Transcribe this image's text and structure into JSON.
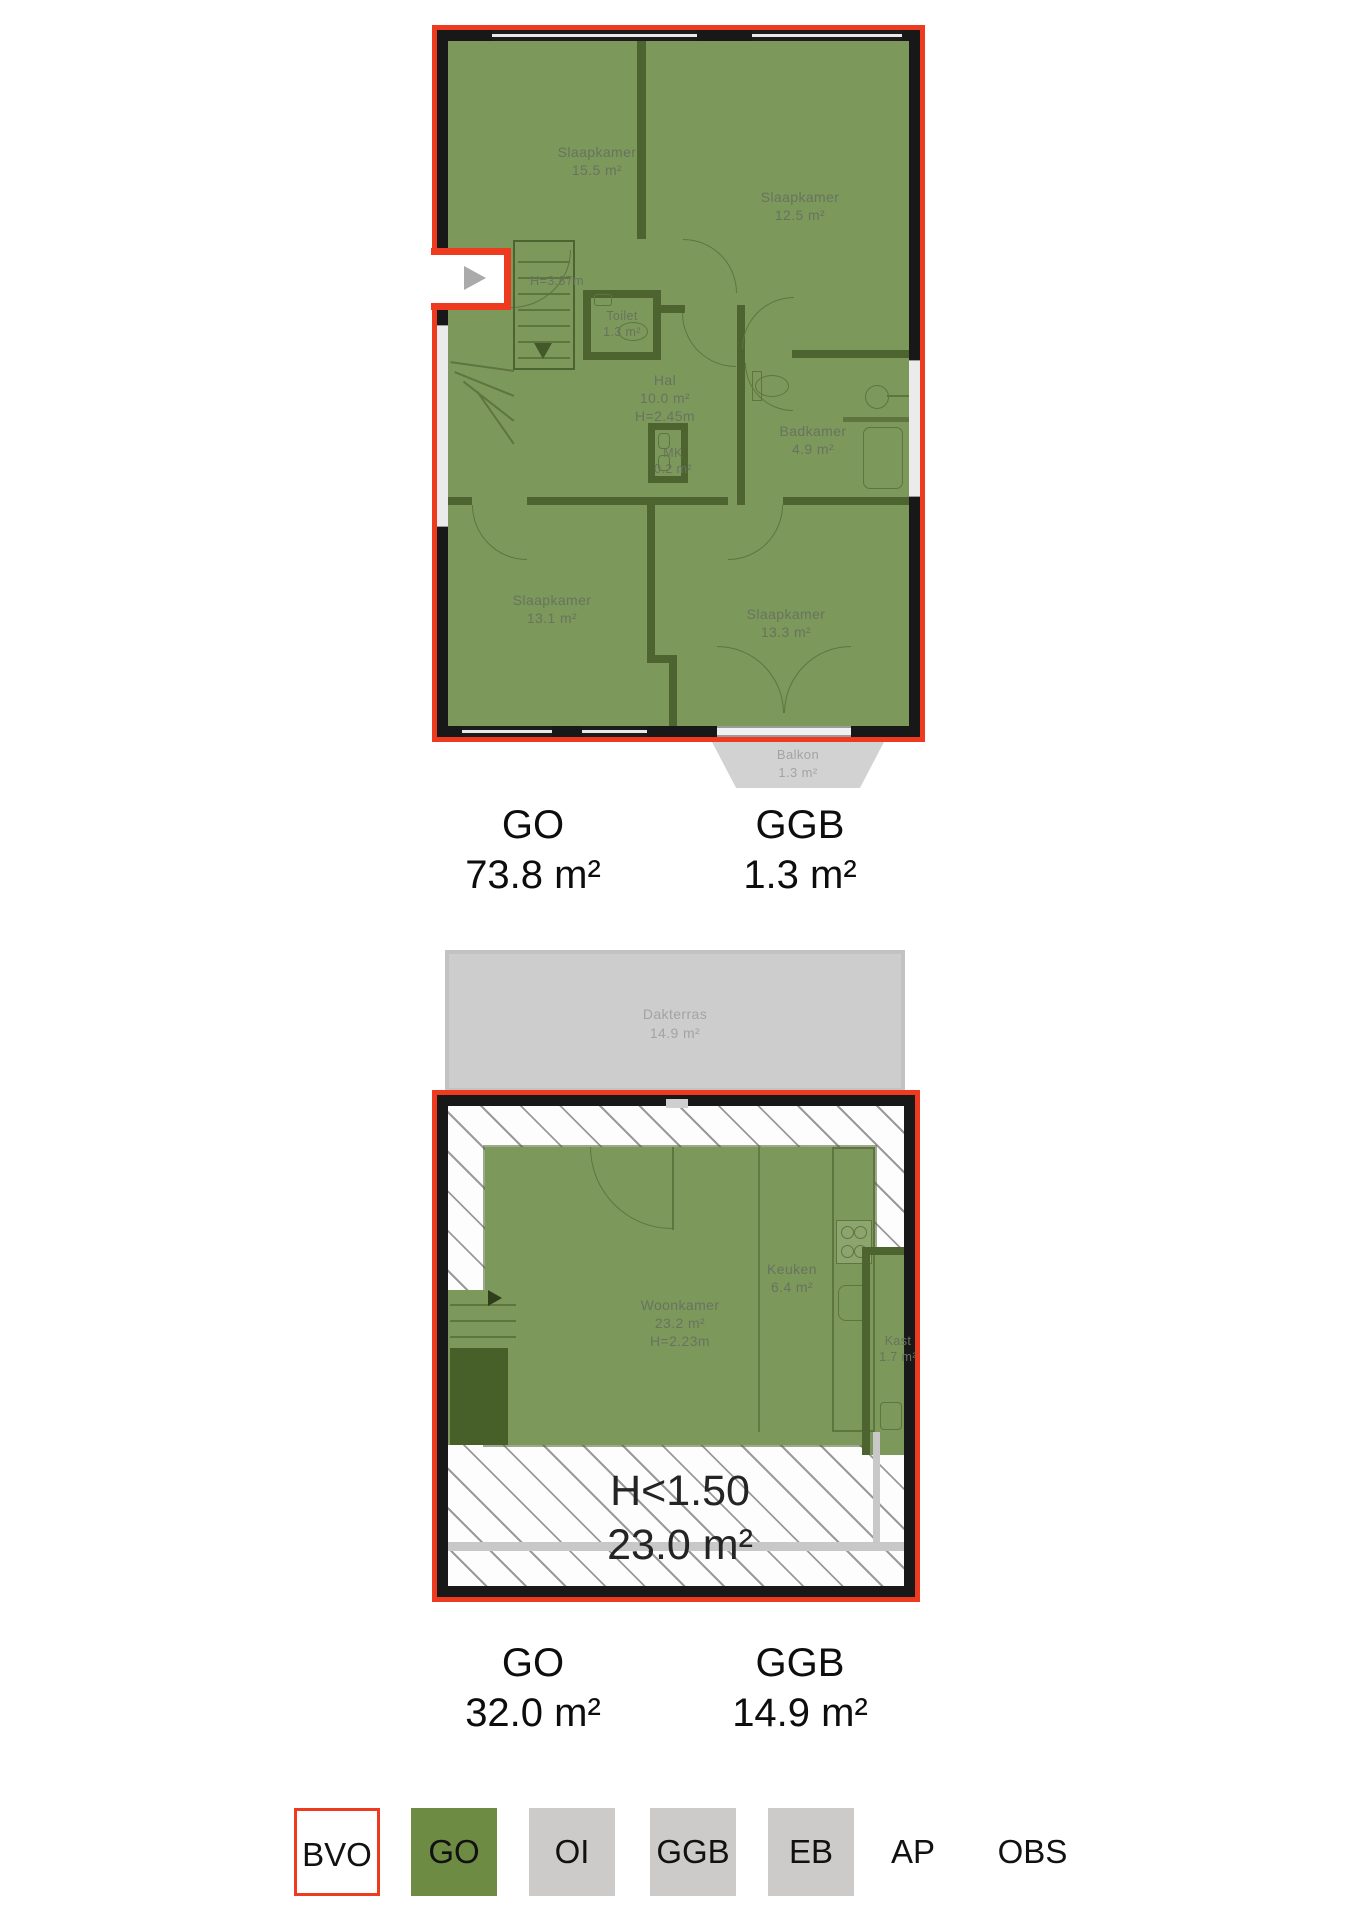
{
  "colors": {
    "outline_red": "#ee3a1f",
    "wall_black": "#181818",
    "room_green": "#7d985b",
    "wall_green": "#4d6430",
    "room_label_gray": "#68735f",
    "outside_gray": "#d0d0d0",
    "outside_label_gray": "#a3a3a3",
    "legend_gray": "#cccbca",
    "legend_green": "#6e8b43",
    "text_black": "#0d0d0d"
  },
  "upper_plan": {
    "rooms": {
      "slaapkamer1": {
        "name": "Slaapkamer",
        "area": "15.5 m²"
      },
      "slaapkamer2": {
        "name": "Slaapkamer",
        "area": "12.5 m²"
      },
      "toilet": {
        "name": "Toilet",
        "area": "1.3 m²"
      },
      "hal": {
        "name": "Hal",
        "area": "10.0 m²",
        "ceiling": "H=2.45m"
      },
      "mk": {
        "name": "MK",
        "area": "0.2 m²"
      },
      "badkamer": {
        "name": "Badkamer",
        "area": "4.9 m²"
      },
      "slaapkamer3": {
        "name": "Slaapkamer",
        "area": "13.1 m²"
      },
      "slaapkamer4": {
        "name": "Slaapkamer",
        "area": "13.3 m²"
      },
      "balkon": {
        "name": "Balkon",
        "area": "1.3 m²"
      }
    },
    "entry_height": "H=3.87m",
    "totals": {
      "go_label": "GO",
      "go_value": "73.8 m²",
      "ggb_label": "GGB",
      "ggb_value": "1.3 m²"
    }
  },
  "lower_plan": {
    "rooms": {
      "dakterras": {
        "name": "Dakterras",
        "area": "14.9 m²"
      },
      "woonkamer": {
        "name": "Woonkamer",
        "area": "23.2 m²",
        "ceiling": "H=2.23m"
      },
      "keuken": {
        "name": "Keuken",
        "area": "6.4 m²"
      },
      "kast": {
        "name": "Kast",
        "area": "1.7 m²"
      }
    },
    "low_headroom": {
      "height": "H<1.50",
      "area": "23.0 m²"
    },
    "totals": {
      "go_label": "GO",
      "go_value": "32.0 m²",
      "ggb_label": "GGB",
      "ggb_value": "14.9 m²"
    }
  },
  "legend": {
    "items": [
      {
        "label": "BVO",
        "box": "bvo"
      },
      {
        "label": "GO",
        "box": "green"
      },
      {
        "label": "OI",
        "box": "gray"
      },
      {
        "label": "GGB",
        "box": "gray"
      },
      {
        "label": "EB",
        "box": "gray"
      },
      {
        "label": "AP",
        "box": "none"
      },
      {
        "label": "OBS",
        "box": "none"
      }
    ]
  }
}
